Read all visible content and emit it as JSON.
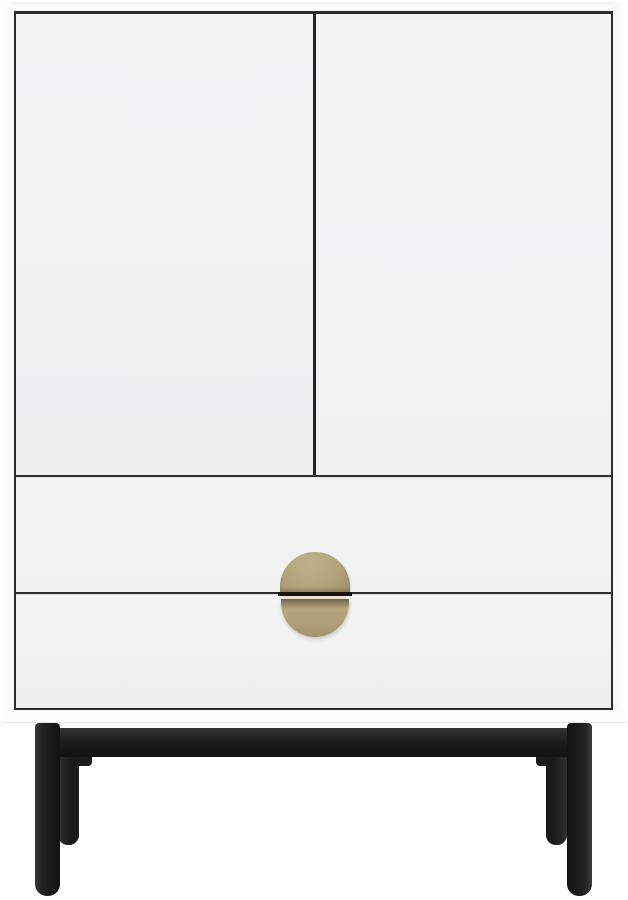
{
  "scene": {
    "type": "furniture-product-photo",
    "subject": "White storage cabinet with two doors, two drawers, split round brass handle and black metal legs",
    "text_visible": "none"
  },
  "colors": {
    "background": "#ffffff",
    "cabinet-face": "#f1f1f2",
    "cabinet-trim": "#f9f9f9",
    "plinth": "#fcfcfc",
    "gap-line": "#2d2d2d",
    "handle-brass": "#b3a47b",
    "handle-brass-dark": "#8d8160",
    "handle-slot": "#eae3d2",
    "leg-black": "#1e1e1e",
    "leg-highlight": "#3a3a3a"
  },
  "parts": [
    {
      "name": "cabinet-top-edge"
    },
    {
      "name": "left-door"
    },
    {
      "name": "right-door"
    },
    {
      "name": "drawer-upper"
    },
    {
      "name": "drawer-lower"
    },
    {
      "name": "handle-top-half"
    },
    {
      "name": "handle-bottom-half"
    },
    {
      "name": "plinth"
    },
    {
      "name": "leg-rail"
    },
    {
      "name": "leg-front-left"
    },
    {
      "name": "leg-front-right"
    },
    {
      "name": "leg-rear-left"
    },
    {
      "name": "leg-rear-right"
    }
  ]
}
